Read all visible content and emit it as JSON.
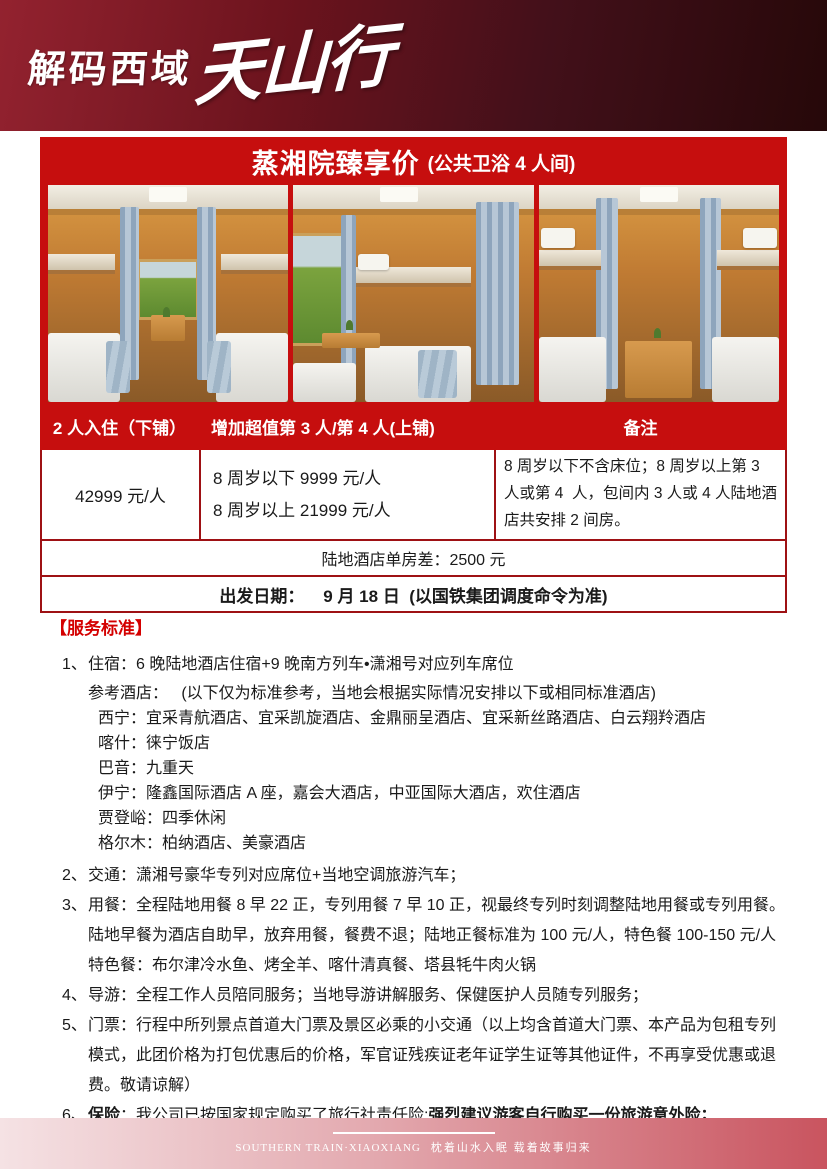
{
  "header": {
    "logo_main": "解码西域",
    "logo_script": "天山行"
  },
  "pricing": {
    "title": "蒸湘院臻享价",
    "title_sub": "(公共卫浴 4 人间)",
    "col_headers": [
      "2 人入住（下铺）",
      "增加超值第 3 人/第 4 人(上铺)",
      "备注"
    ],
    "base_price": "42999 元/人",
    "child_prices": [
      "8 周岁以下 9999 元/人",
      "8 周岁以上 21999 元/人"
    ],
    "remark": "8 周岁以下不含床位；8 周岁以上第 3 人或第 4  人，包间内 3 人或 4 人陆地酒店共安排 2 间房。",
    "single_supplement": "陆地酒店单房差：2500 元",
    "departure": "出发日期：    9 月 18 日  (以国铁集团调度命令为准)"
  },
  "services": {
    "heading": "【服务标准】",
    "item1": {
      "num": "1、",
      "text": "住宿：6 晚陆地酒店住宿+9 晚南方列车•潇湘号对应列车席位"
    },
    "hotels_intro": "参考酒店：   (以下仅为标准参考，当地会根据实际情况安排以下或相同标准酒店)",
    "hotels": [
      "西宁：宜采青航酒店、宜采凯旋酒店、金鼎丽呈酒店、宜采新丝路酒店、白云翔羚酒店",
      "喀什：徕宁饭店",
      "巴音：九重天",
      "伊宁：隆鑫国际酒店 A 座，嘉会大酒店，中亚国际大酒店，欢住酒店",
      "贾登峪：四季休闲",
      "格尔木：柏纳酒店、美豪酒店"
    ],
    "item2": {
      "num": "2、",
      "text": "交通：潇湘号豪华专列对应席位+当地空调旅游汽车；"
    },
    "item3": {
      "num": "3、",
      "text": "用餐：全程陆地用餐 8 早 22 正，专列用餐 7 早 10 正，视最终专列时刻调整陆地用餐或专列用餐。陆地早餐为酒店自助早，放弃用餐，餐费不退；陆地正餐标准为 100 元/人，特色餐 100-150 元/人    特色餐：布尔津冷水鱼、烤全羊、喀什清真餐、塔县牦牛肉火锅"
    },
    "item4": {
      "num": "4、",
      "text": "导游：全程工作人员陪同服务；当地导游讲解服务、保健医护人员随专列服务；"
    },
    "item5": {
      "num": "5、",
      "text": "门票：行程中所列景点首道大门票及景区必乘的小交通（以上均含首道大门票、本产品为包租专列模式，此团价格为打包优惠后的价格，军官证残疾证老年证学生证等其他证件，不再享受优惠或退费。敬请谅解）"
    },
    "item6": {
      "num": "6、",
      "label": "保险",
      "mid": "：我公司已按国家规定购买了旅行社责任险;",
      "bold": "强烈建议游客自行购买一份旅游意外险；"
    }
  },
  "footer": {
    "brand": "SOUTHERN TRAIN·XIAOXIANG",
    "slogan": "枕着山水入眠 载着故事归来"
  },
  "colors": {
    "banner_red": "#c60e0e",
    "table_border_red": "#9e1114",
    "heading_red": "#d40000",
    "header_dark_red": "#6b131d",
    "footer_rose": "#c9545f"
  }
}
